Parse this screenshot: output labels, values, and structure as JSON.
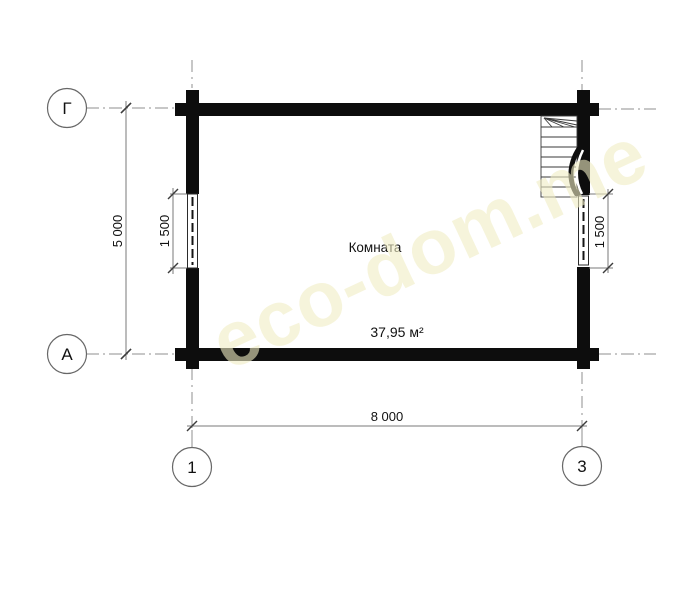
{
  "plan": {
    "room_name": "Комната",
    "room_area": "37,95 м²",
    "watermark": "eco-dom.me"
  },
  "dimensions": {
    "overall_height": "5 000",
    "overall_width": "8 000",
    "left_window": "1 500",
    "right_window": "1 500"
  },
  "axes": {
    "row_top": "Г",
    "row_bottom": "А",
    "column_left": "1",
    "column_right": "3"
  },
  "colors": {
    "wall": "#0d0d0d",
    "thin_line": "#2b2b2b",
    "dimension_line": "#7a7a7a",
    "axis_line": "#8f8f8f",
    "text": "#111111",
    "watermark": "#efe9bc"
  }
}
